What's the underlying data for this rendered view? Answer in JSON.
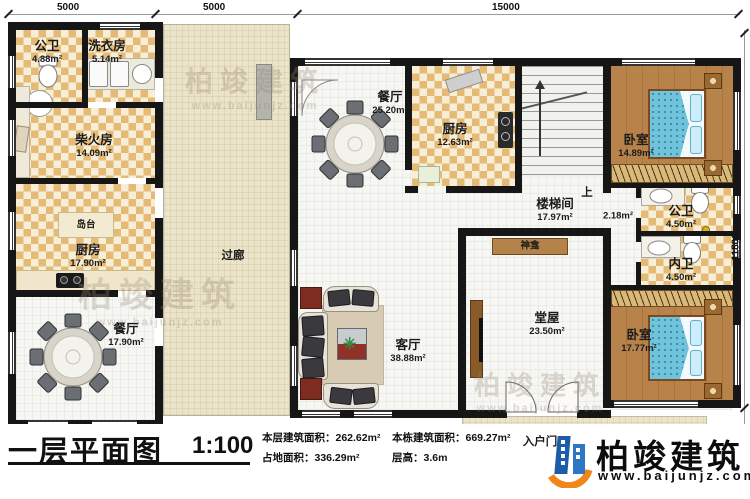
{
  "dimensions": {
    "top": [
      "5000",
      "5000",
      "15000"
    ],
    "right": [
      "11800",
      "2000"
    ]
  },
  "rooms": {
    "gw1": {
      "label": "公卫",
      "area": "4.88m²"
    },
    "laundry": {
      "label": "洗衣房",
      "area": "5.14m²"
    },
    "chai": {
      "label": "柴火房",
      "area": "14.09m²"
    },
    "kitchen_l": {
      "label": "厨房",
      "area": "17.90m²"
    },
    "island": {
      "label": "岛台"
    },
    "dining_l": {
      "label": "餐厅",
      "area": "17.90m²"
    },
    "corridor": {
      "label": "过廊"
    },
    "dining_m": {
      "label": "餐厅",
      "area": "25.20m²"
    },
    "kitchen_m": {
      "label": "厨房",
      "area": "12.63m²"
    },
    "stair": {
      "label": "楼梯间",
      "area": "17.97m²"
    },
    "up": {
      "label": "上"
    },
    "hall": {
      "area": "2.18m²"
    },
    "bed1": {
      "label": "卧室",
      "area": "14.89m²"
    },
    "gw2": {
      "label": "公卫",
      "area": "4.50m²"
    },
    "nw": {
      "label": "内卫",
      "area": "4.50m²"
    },
    "bed2": {
      "label": "卧室",
      "area": "17.77m²"
    },
    "tangwu": {
      "label": "堂屋",
      "area": "23.50m²"
    },
    "shrine": {
      "label": "神龛"
    },
    "living": {
      "label": "客厅",
      "area": "38.88m²"
    },
    "entry": {
      "label": "入户门"
    }
  },
  "titlebar": {
    "title": "一层平面图",
    "scale": "1:100",
    "stats": [
      {
        "label": "本层建筑面积：",
        "value": "262.62m²"
      },
      {
        "label": "本栋建筑面积：",
        "value": "669.27m²"
      },
      {
        "label": "占地面积：",
        "value": "336.29m²"
      },
      {
        "label": "层高：",
        "value": "3.6m"
      }
    ]
  },
  "logo": {
    "name": "柏竣建筑",
    "website": "www.baijunjz.com"
  },
  "watermark": {
    "name": "柏竣建筑",
    "website": "www.baijunjz.com"
  },
  "colors": {
    "wall": "#161616",
    "check_tan": "#e5ba75",
    "wood": "#b8834a",
    "bed_blue": "#6fc3da",
    "logo_blue": "#1d5ca6",
    "logo_orange": "#f08519"
  }
}
